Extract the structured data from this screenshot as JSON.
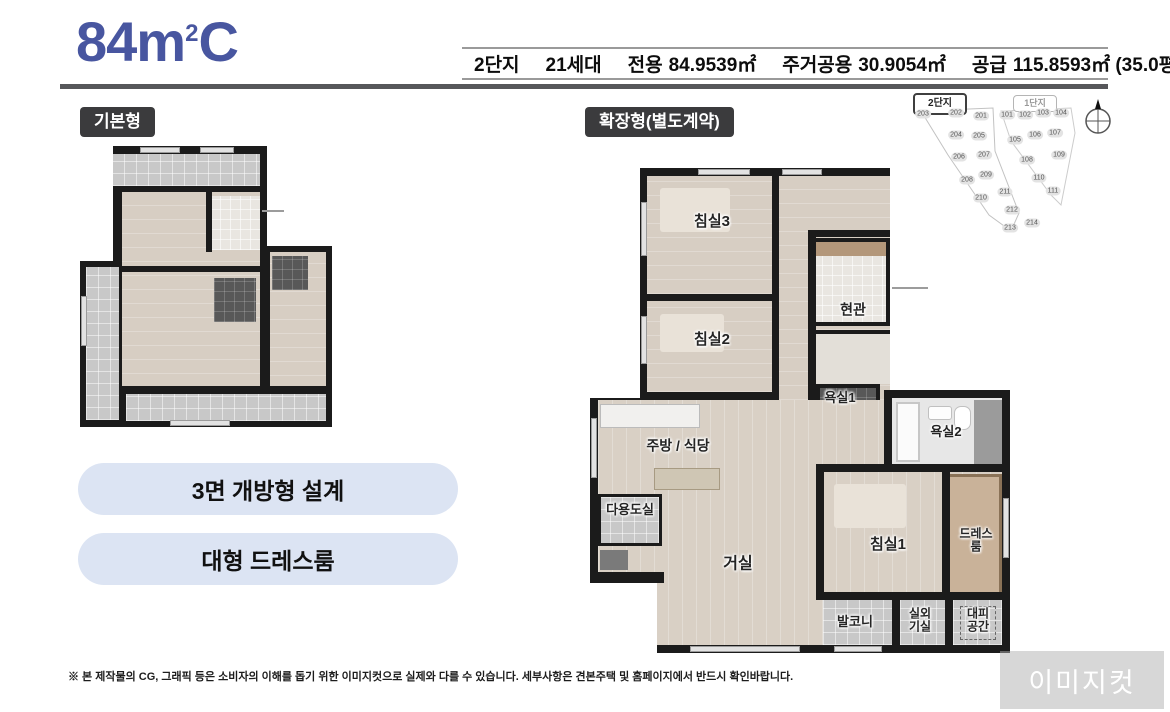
{
  "header": {
    "title": {
      "main": "84m",
      "sup": "2",
      "tail": "C"
    },
    "info": {
      "complex": "2단지",
      "households": "21세대",
      "areas": [
        {
          "label": "전용",
          "value": "84.9539㎡"
        },
        {
          "label": "주거공용",
          "value": "30.9054㎡"
        },
        {
          "label": "공급",
          "value": "115.8593㎡ (35.0평)"
        }
      ]
    }
  },
  "plans": {
    "basic_tag": "기본형",
    "extended_tag": "확장형(별도계약)"
  },
  "features": [
    "3면 개방형 설계",
    "대형 드레스룸"
  ],
  "floorplan_extended": {
    "rooms": [
      {
        "label": "침실3",
        "x": 122,
        "y": 54,
        "size": 15
      },
      {
        "label": "침실2",
        "x": 122,
        "y": 172,
        "size": 15
      },
      {
        "label": "현관",
        "x": 263,
        "y": 142,
        "size": 14
      },
      {
        "label": "욕실1",
        "x": 250,
        "y": 230,
        "size": 13
      },
      {
        "label": "욕실2",
        "x": 356,
        "y": 264,
        "size": 13
      },
      {
        "label": "주방 / 식당",
        "x": 88,
        "y": 278,
        "size": 14
      },
      {
        "label": "다용도실",
        "x": 40,
        "y": 342,
        "size": 13
      },
      {
        "label": "거실",
        "x": 148,
        "y": 397,
        "size": 16
      },
      {
        "label": "침실1",
        "x": 298,
        "y": 377,
        "size": 15
      },
      {
        "label": "드레스룸",
        "x": 386,
        "y": 372,
        "size": 12
      },
      {
        "label": "발코니",
        "x": 265,
        "y": 454,
        "size": 13
      },
      {
        "label": "실외\n기실",
        "x": 330,
        "y": 452,
        "size": 12
      },
      {
        "label": "대피\n공간",
        "x": 388,
        "y": 452,
        "size": 12
      }
    ]
  },
  "site_plan": {
    "complex2": {
      "label": "2단지",
      "units": [
        {
          "n": "203",
          "x": 30,
          "y": 21
        },
        {
          "n": "202",
          "x": 63,
          "y": 20
        },
        {
          "n": "201",
          "x": 88,
          "y": 23
        },
        {
          "n": "204",
          "x": 63,
          "y": 42
        },
        {
          "n": "205",
          "x": 86,
          "y": 43
        },
        {
          "n": "206",
          "x": 66,
          "y": 64
        },
        {
          "n": "207",
          "x": 91,
          "y": 62
        },
        {
          "n": "208",
          "x": 74,
          "y": 87
        },
        {
          "n": "209",
          "x": 93,
          "y": 82
        },
        {
          "n": "210",
          "x": 88,
          "y": 105
        },
        {
          "n": "211",
          "x": 112,
          "y": 99
        },
        {
          "n": "212",
          "x": 119,
          "y": 117
        },
        {
          "n": "213",
          "x": 117,
          "y": 135
        },
        {
          "n": "214",
          "x": 139,
          "y": 130
        }
      ]
    },
    "complex1": {
      "label": "1단지",
      "units": [
        {
          "n": "101",
          "x": 114,
          "y": 22
        },
        {
          "n": "102",
          "x": 132,
          "y": 22
        },
        {
          "n": "103",
          "x": 150,
          "y": 20
        },
        {
          "n": "104",
          "x": 168,
          "y": 20
        },
        {
          "n": "105",
          "x": 122,
          "y": 47
        },
        {
          "n": "106",
          "x": 142,
          "y": 42
        },
        {
          "n": "107",
          "x": 162,
          "y": 40
        },
        {
          "n": "108",
          "x": 134,
          "y": 67
        },
        {
          "n": "109",
          "x": 166,
          "y": 62
        },
        {
          "n": "110",
          "x": 146,
          "y": 85
        },
        {
          "n": "111",
          "x": 160,
          "y": 98
        }
      ]
    }
  },
  "footer": {
    "disclaimer": "※ 본 제작물의 CG, 그래픽 등은 소비자의 이해를 돕기 위한 이미지컷으로 실제와 다를 수 있습니다. 세부사항은 견본주택 및 홈페이지에서 반드시 확인바랍니다.",
    "watermark": "이미지컷"
  }
}
